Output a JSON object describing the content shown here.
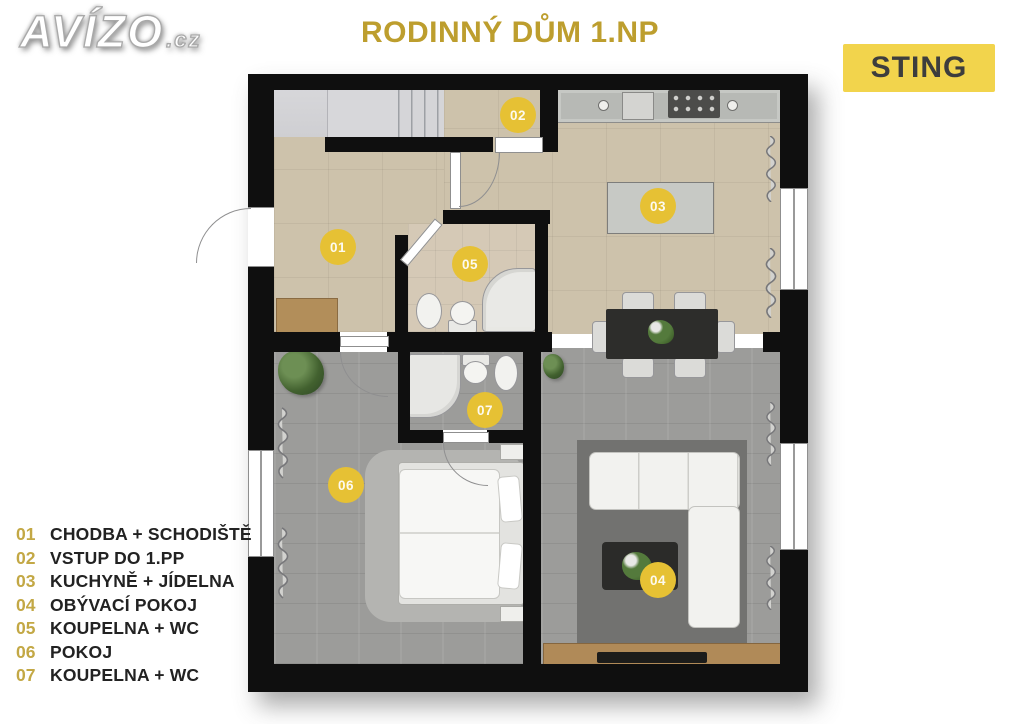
{
  "brand": {
    "logo": "AVÍZO",
    "logo_suffix": ".cz"
  },
  "header": {
    "title": "RODINNÝ DŮM 1.NP",
    "agency": "STING"
  },
  "legend": {
    "items": [
      {
        "num": "01",
        "label": "CHODBA + SCHODIŠTĚ"
      },
      {
        "num": "02",
        "label": "VSTUP DO 1.PP"
      },
      {
        "num": "03",
        "label": "KUCHYNĚ + JÍDELNA"
      },
      {
        "num": "04",
        "label": "OBÝVACÍ POKOJ"
      },
      {
        "num": "05",
        "label": "KOUPELNA + WC"
      },
      {
        "num": "06",
        "label": "POKOJ"
      },
      {
        "num": "07",
        "label": "KOUPELNA + WC"
      }
    ]
  },
  "plan": {
    "room_badges": [
      {
        "num": "01"
      },
      {
        "num": "02"
      },
      {
        "num": "03"
      },
      {
        "num": "04"
      },
      {
        "num": "05"
      },
      {
        "num": "06"
      },
      {
        "num": "07"
      }
    ]
  },
  "colors": {
    "accent_gold": "#bd9e2e",
    "badge_yellow": "#e6c134",
    "sting_bg": "#f2d44c",
    "wall_black": "#0f0f0f",
    "floor_beige": "#cdc2ab",
    "floor_gray": "#9c9c9a"
  }
}
